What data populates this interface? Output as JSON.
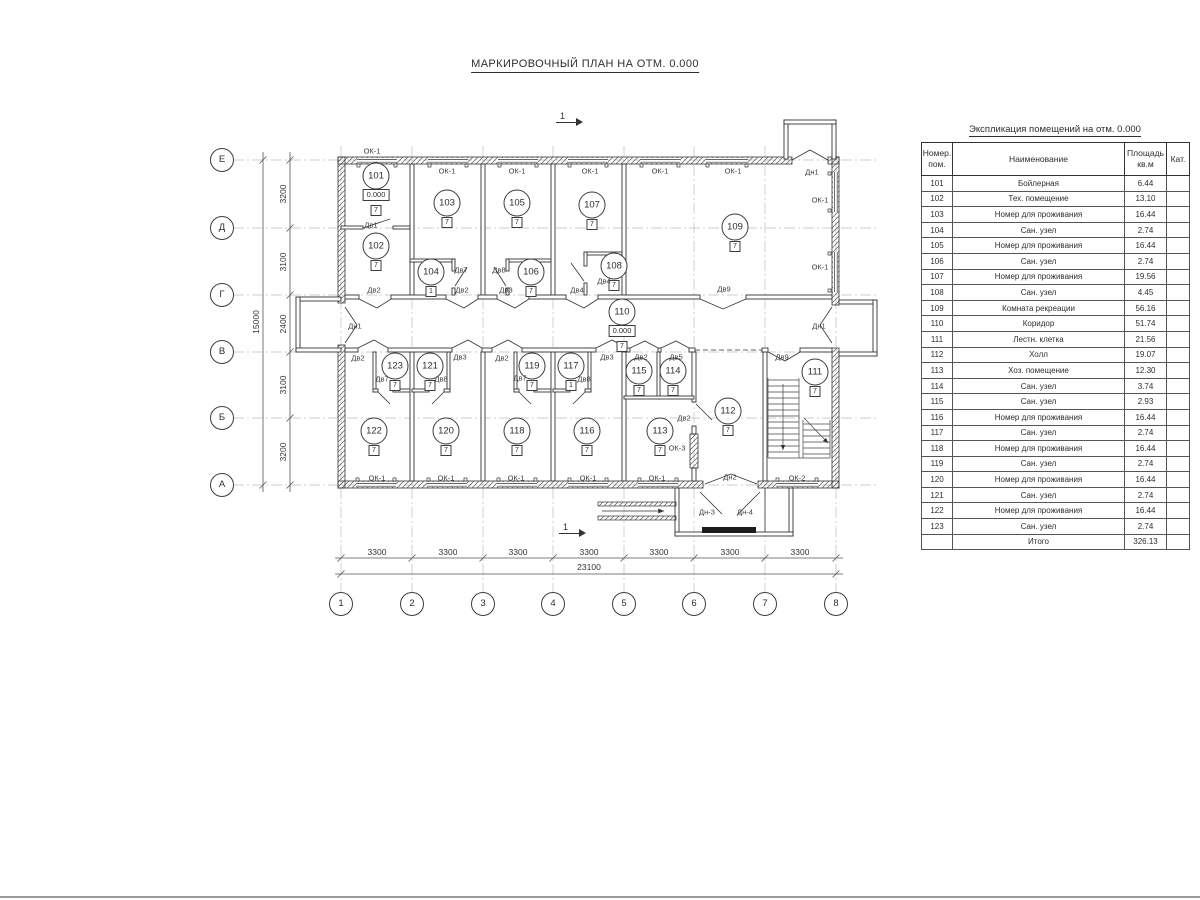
{
  "page": {
    "title": "МАРКИРОВОЧНЫЙ ПЛАН НА ОТМ. 0.000"
  },
  "plan": {
    "level_mark": "0.000",
    "section_marks": [
      {
        "label": "1",
        "x": 560,
        "y": 122
      },
      {
        "label": "1",
        "x": 563,
        "y": 533
      }
    ],
    "grid": {
      "columns": [
        {
          "label": "1",
          "x": 341
        },
        {
          "label": "2",
          "x": 412
        },
        {
          "label": "3",
          "x": 483
        },
        {
          "label": "4",
          "x": 553
        },
        {
          "label": "5",
          "x": 624
        },
        {
          "label": "6",
          "x": 694
        },
        {
          "label": "7",
          "x": 765
        },
        {
          "label": "8",
          "x": 836
        }
      ],
      "rows": [
        {
          "label": "Е",
          "y": 160
        },
        {
          "label": "Д",
          "y": 228
        },
        {
          "label": "Г",
          "y": 295
        },
        {
          "label": "В",
          "y": 352
        },
        {
          "label": "Б",
          "y": 418
        },
        {
          "label": "А",
          "y": 485
        }
      ]
    },
    "dimensions": {
      "bottom_segments": [
        {
          "text": "3300",
          "x": 377
        },
        {
          "text": "3300",
          "x": 448
        },
        {
          "text": "3300",
          "x": 518
        },
        {
          "text": "3300",
          "x": 589
        },
        {
          "text": "3300",
          "x": 659
        },
        {
          "text": "3300",
          "x": 730
        },
        {
          "text": "3300",
          "x": 800
        }
      ],
      "bottom_total": "23100",
      "left_segments": [
        {
          "text": "3200",
          "y": 194
        },
        {
          "text": "3100",
          "y": 262
        },
        {
          "text": "2400",
          "y": 324
        },
        {
          "text": "3100",
          "y": 385
        },
        {
          "text": "3200",
          "y": 452
        }
      ],
      "left_total": "15000"
    },
    "rooms": [
      {
        "num": "101",
        "x": 376,
        "y": 176,
        "level": "0.000",
        "tag": "7"
      },
      {
        "num": "102",
        "x": 376,
        "y": 246,
        "tag": "7"
      },
      {
        "num": "103",
        "x": 447,
        "y": 203,
        "tag": "7"
      },
      {
        "num": "104",
        "x": 431,
        "y": 272,
        "tag": "1"
      },
      {
        "num": "105",
        "x": 517,
        "y": 203,
        "tag": "7"
      },
      {
        "num": "106",
        "x": 531,
        "y": 272,
        "tag": "7"
      },
      {
        "num": "107",
        "x": 592,
        "y": 205,
        "tag": "7"
      },
      {
        "num": "108",
        "x": 614,
        "y": 266,
        "tag": "7"
      },
      {
        "num": "109",
        "x": 735,
        "y": 227,
        "tag": "7"
      },
      {
        "num": "110",
        "x": 622,
        "y": 312,
        "level": "0.000",
        "tag": "7"
      },
      {
        "num": "111",
        "x": 815,
        "y": 372,
        "tag": "7"
      },
      {
        "num": "112",
        "x": 728,
        "y": 411,
        "tag": "7"
      },
      {
        "num": "113",
        "x": 660,
        "y": 431,
        "tag": "7"
      },
      {
        "num": "114",
        "x": 673,
        "y": 371,
        "tag": "7"
      },
      {
        "num": "115",
        "x": 639,
        "y": 371,
        "tag": "7"
      },
      {
        "num": "116",
        "x": 587,
        "y": 431,
        "tag": "7"
      },
      {
        "num": "117",
        "x": 571,
        "y": 366,
        "tag": "1"
      },
      {
        "num": "118",
        "x": 517,
        "y": 431,
        "tag": "7"
      },
      {
        "num": "119",
        "x": 532,
        "y": 366,
        "tag": "7"
      },
      {
        "num": "120",
        "x": 446,
        "y": 431,
        "tag": "7"
      },
      {
        "num": "121",
        "x": 430,
        "y": 366,
        "tag": "7"
      },
      {
        "num": "122",
        "x": 374,
        "y": 431,
        "tag": "7"
      },
      {
        "num": "123",
        "x": 395,
        "y": 366,
        "tag": "7"
      }
    ],
    "labels": [
      {
        "t": "ОК-1",
        "x": 372,
        "y": 151
      },
      {
        "t": "ОК-1",
        "x": 447,
        "y": 171
      },
      {
        "t": "ОК-1",
        "x": 517,
        "y": 171
      },
      {
        "t": "ОК-1",
        "x": 590,
        "y": 171
      },
      {
        "t": "ОК-1",
        "x": 660,
        "y": 171
      },
      {
        "t": "ОК-1",
        "x": 733,
        "y": 171
      },
      {
        "t": "Дн1",
        "x": 812,
        "y": 172
      },
      {
        "t": "ОК-1",
        "x": 820,
        "y": 200
      },
      {
        "t": "ОК-1",
        "x": 820,
        "y": 267
      },
      {
        "t": "Дв1",
        "x": 371,
        "y": 225
      },
      {
        "t": "Дв7",
        "x": 461,
        "y": 270
      },
      {
        "t": "Дв8",
        "x": 499,
        "y": 270
      },
      {
        "t": "Дв4",
        "x": 604,
        "y": 281
      },
      {
        "t": "Дв4",
        "x": 577,
        "y": 290
      },
      {
        "t": "Дв2",
        "x": 374,
        "y": 290
      },
      {
        "t": "Дв2",
        "x": 462,
        "y": 290
      },
      {
        "t": "Дв3",
        "x": 506,
        "y": 290
      },
      {
        "t": "Дв9",
        "x": 724,
        "y": 289
      },
      {
        "t": "Дн1",
        "x": 355,
        "y": 326
      },
      {
        "t": "Дн1",
        "x": 819,
        "y": 326
      },
      {
        "t": "Дв2",
        "x": 358,
        "y": 358
      },
      {
        "t": "Дв3",
        "x": 460,
        "y": 357
      },
      {
        "t": "Дв2",
        "x": 502,
        "y": 358
      },
      {
        "t": "Дв3",
        "x": 607,
        "y": 357
      },
      {
        "t": "Дв2",
        "x": 641,
        "y": 357
      },
      {
        "t": "Дв5",
        "x": 676,
        "y": 357
      },
      {
        "t": "Дв9",
        "x": 782,
        "y": 357
      },
      {
        "t": "Дв7",
        "x": 382,
        "y": 379
      },
      {
        "t": "Дв8",
        "x": 441,
        "y": 379
      },
      {
        "t": "Дв7",
        "x": 520,
        "y": 378
      },
      {
        "t": "Дв8",
        "x": 584,
        "y": 379
      },
      {
        "t": "Дв2",
        "x": 684,
        "y": 418
      },
      {
        "t": "ОК-3",
        "x": 677,
        "y": 448
      },
      {
        "t": "ОК-1",
        "x": 377,
        "y": 478
      },
      {
        "t": "ОК-1",
        "x": 446,
        "y": 478
      },
      {
        "t": "ОК-1",
        "x": 516,
        "y": 478
      },
      {
        "t": "ОК-1",
        "x": 588,
        "y": 478
      },
      {
        "t": "ОК-1",
        "x": 657,
        "y": 478
      },
      {
        "t": "Дн2",
        "x": 730,
        "y": 477
      },
      {
        "t": "ОК-2",
        "x": 797,
        "y": 478
      },
      {
        "t": "Дн-3",
        "x": 707,
        "y": 512
      },
      {
        "t": "Дн-4",
        "x": 745,
        "y": 512
      }
    ]
  },
  "table": {
    "title": "Экспликация помещений на отм. 0.000",
    "headers": {
      "num_l1": "Номер.",
      "num_l2": "пом.",
      "name": "Наименование",
      "area_l1": "Площадь",
      "area_l2": "кв.м",
      "cat": "Кат."
    },
    "rows": [
      {
        "num": "101",
        "name": "Бойлерная",
        "area": "6.44"
      },
      {
        "num": "102",
        "name": "Тех. помещение",
        "area": "13.10"
      },
      {
        "num": "103",
        "name": "Номер для проживания",
        "area": "16.44"
      },
      {
        "num": "104",
        "name": "Сан. узел",
        "area": "2.74"
      },
      {
        "num": "105",
        "name": "Номер для проживания",
        "area": "16.44"
      },
      {
        "num": "106",
        "name": "Сан. узел",
        "area": "2.74"
      },
      {
        "num": "107",
        "name": "Номер для проживания",
        "area": "19.56"
      },
      {
        "num": "108",
        "name": "Сан. узел",
        "area": "4.45"
      },
      {
        "num": "109",
        "name": "Комната рекреации",
        "area": "56.16"
      },
      {
        "num": "110",
        "name": "Коридор",
        "area": "51.74"
      },
      {
        "num": "111",
        "name": "Лестн. клетка",
        "area": "21.56"
      },
      {
        "num": "112",
        "name": "Холл",
        "area": "19.07"
      },
      {
        "num": "113",
        "name": "Хоз. помещение",
        "area": "12.30"
      },
      {
        "num": "114",
        "name": "Сан. узел",
        "area": "3.74"
      },
      {
        "num": "115",
        "name": "Сан. узел",
        "area": "2.93"
      },
      {
        "num": "116",
        "name": "Номер для проживания",
        "area": "16.44"
      },
      {
        "num": "117",
        "name": "Сан. узел",
        "area": "2.74"
      },
      {
        "num": "118",
        "name": "Номер для проживания",
        "area": "16.44"
      },
      {
        "num": "119",
        "name": "Сан. узел",
        "area": "2.74"
      },
      {
        "num": "120",
        "name": "Номер для проживания",
        "area": "16.44"
      },
      {
        "num": "121",
        "name": "Сан. узел",
        "area": "2.74"
      },
      {
        "num": "122",
        "name": "Номер для проживания",
        "area": "16.44"
      },
      {
        "num": "123",
        "name": "Сан. узел",
        "area": "2.74"
      }
    ],
    "total_label": "Итого",
    "total": "326.13"
  }
}
